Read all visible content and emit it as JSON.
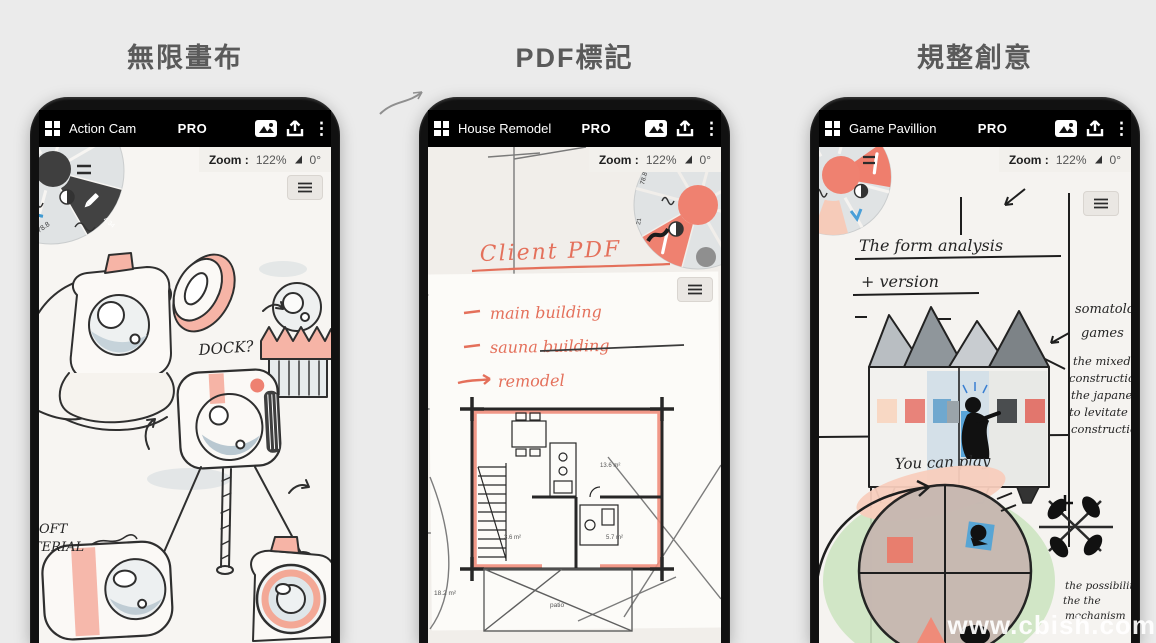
{
  "page": {
    "watermark": "www.cbish.com"
  },
  "columns": [
    {
      "title": "無限畫布",
      "app": {
        "name": "Action Cam",
        "pro": "PRO"
      },
      "zoom": {
        "label": "Zoom :",
        "value": "122%",
        "angle": "0°"
      },
      "wheel": {
        "size_label": "78.8",
        "tool_label": "4.34"
      },
      "canvas": {
        "dock": "DOCK?",
        "soft_1": "OFT",
        "soft_2": "TERIAL"
      }
    },
    {
      "title": "PDF標記",
      "app": {
        "name": "House Remodel",
        "pro": "PRO"
      },
      "zoom": {
        "label": "Zoom :",
        "value": "122%",
        "angle": "0°"
      },
      "wheel": {
        "size_label": "78.8",
        "stroke_label": "21",
        "brush_label": "8.4"
      },
      "canvas": {
        "heading": "Client PDF",
        "note_1": "main building",
        "note_2": "sauna building",
        "note_3": "remodel",
        "room_large": "13.6 m²",
        "room_small": "3.6 m²",
        "room_mid": "5.7 m²",
        "patio_label": "patio",
        "area_note": "18.2 m²"
      }
    },
    {
      "title": "規整創意",
      "app": {
        "name": "Game Pavillion",
        "pro": "PRO"
      },
      "zoom": {
        "label": "Zoom :",
        "value": "122%",
        "angle": "0°"
      },
      "canvas": {
        "heading_1": "The form analysis",
        "heading_2": "+ version",
        "side_1": "somatology",
        "side_2": "games",
        "right_lines": [
          "the mixed",
          "construction is",
          "the japanese'",
          "to levitate above",
          "construction."
        ],
        "play_1": "You can play",
        "play_2": "alone",
        "bottom_lines": [
          "the possibility of",
          "the the",
          "mechanism"
        ]
      }
    }
  ]
}
